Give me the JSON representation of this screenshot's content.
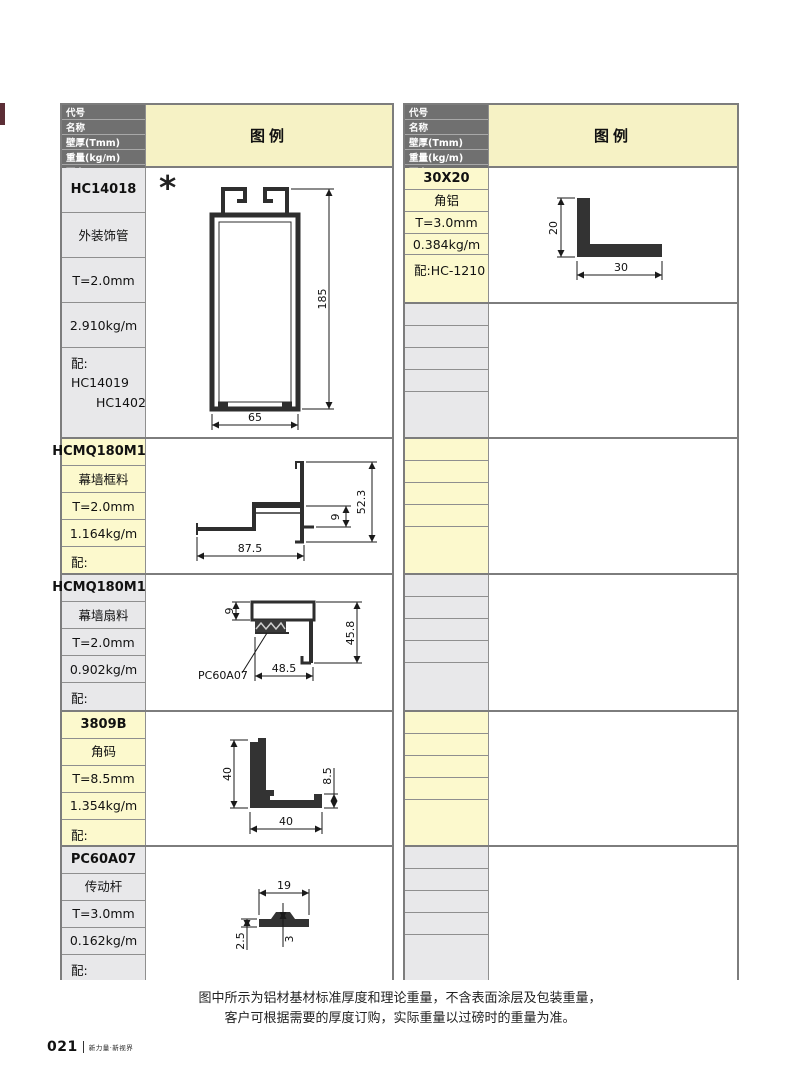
{
  "page": {
    "page_number": "021",
    "page_slogan": "新力量·新视界",
    "footnote_line1": "图中所示为铝材基材标准厚度和理论重量，不含表面涂层及包装重量，",
    "footnote_line2": "客户可根据需要的厚度订购，实际重量以过磅时的重量为准。"
  },
  "colors": {
    "header_bg": "#707070",
    "legend_header_bg": "#f6f2c5",
    "label_yellow": "#fcf9cd",
    "label_gray": "#e8e8ea",
    "edge_mark": "#5c2e36",
    "profile_ink": "#2e2e2e"
  },
  "table_header": {
    "rows": [
      "代号",
      "名称",
      "壁厚(Tmm)",
      "重量(kg/m)",
      "配套"
    ],
    "legend": "图例"
  },
  "left_table": {
    "blocks": [
      {
        "code": "HC14018",
        "name": "外装饰管",
        "thickness": "T=2.0mm",
        "weight": "2.910kg/m",
        "match_line1": "配: HC14019",
        "match_line2": "HC14024",
        "marker": "*",
        "dim_height": "185",
        "dim_width": "65"
      },
      {
        "code": "HCMQ180M15",
        "name": "幕墙框料",
        "thickness": "T=2.0mm",
        "weight": "1.164kg/m",
        "match_line1": "配:",
        "dim_width": "87.5",
        "dim_step": "9",
        "dim_height": "52.3"
      },
      {
        "code": "HCMQ180M16",
        "name": "幕墙扇料",
        "thickness": "T=2.0mm",
        "weight": "0.902kg/m",
        "match_line1": "配:",
        "dim_top": "9",
        "dim_height": "45.8",
        "dim_width": "48.5",
        "callout": "PC60A07"
      },
      {
        "code": "3809B",
        "name": "角码",
        "thickness": "T=8.5mm",
        "weight": "1.354kg/m",
        "match_line1": "配:",
        "dim_leg": "40",
        "dim_thickness": "8.5",
        "dim_width": "40"
      },
      {
        "code": "PC60A07",
        "name": "传动杆",
        "thickness": "T=3.0mm",
        "weight": "0.162kg/m",
        "match_line1": "配:",
        "dim_width": "19",
        "dim_left": "2.5",
        "dim_mid": "3"
      }
    ]
  },
  "right_table": {
    "blocks": [
      {
        "code": "30X20",
        "name": "角铝",
        "thickness": "T=3.0mm",
        "weight": "0.384kg/m",
        "match_line1": "配:HC-1210",
        "dim_leg": "20",
        "dim_width": "30"
      }
    ]
  }
}
